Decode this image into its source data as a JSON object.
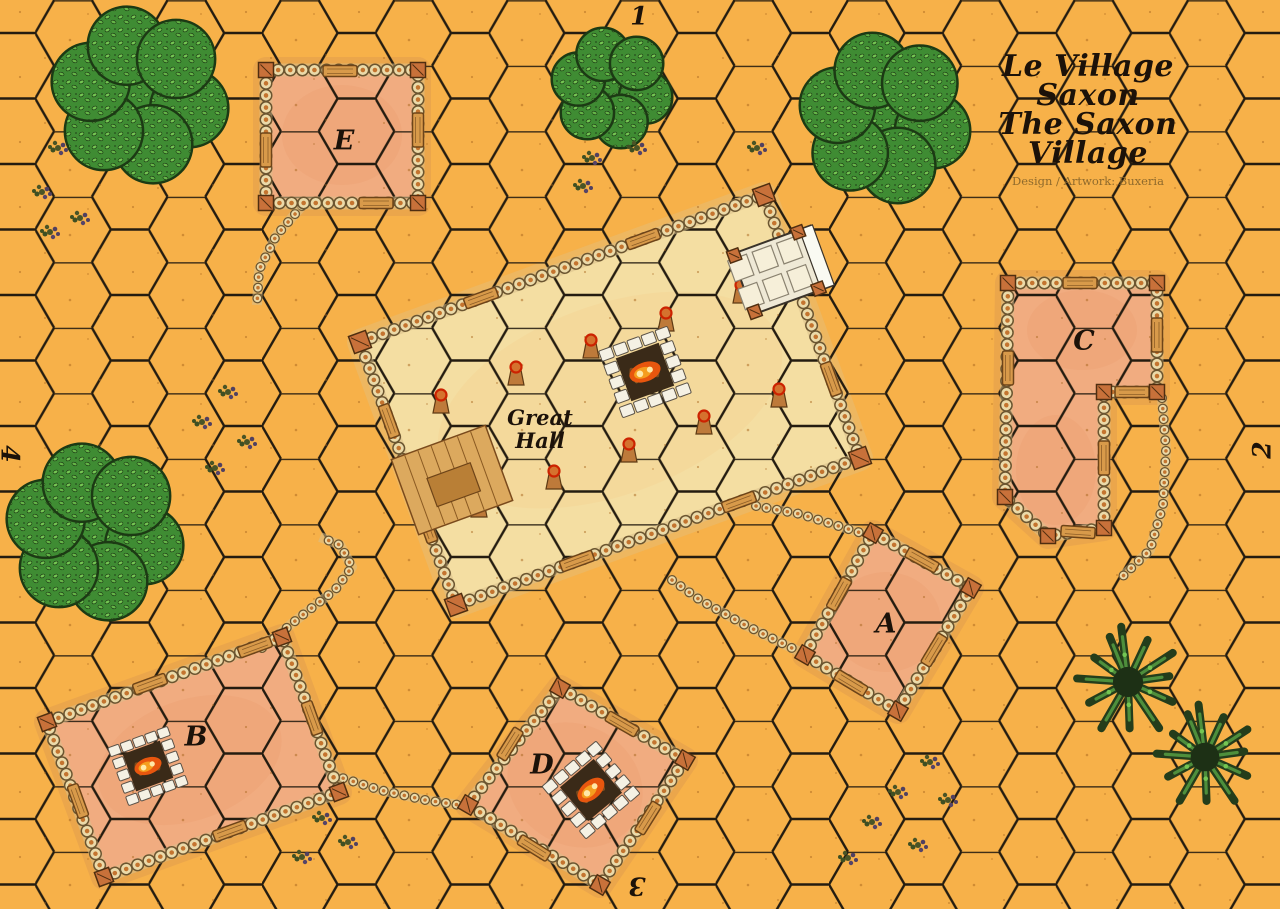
{
  "map": {
    "title_line1": "Le Village Saxon",
    "title_line2": "The Saxon Village",
    "credit": "Design / Artwork: Buxeria",
    "edge_numbers": {
      "top": "1",
      "right": "2",
      "bottom": "3",
      "left": "4"
    }
  },
  "buildings": {
    "great_hall": {
      "label_line1": "Great",
      "label_line2": "Hall"
    },
    "a": {
      "label": "A"
    },
    "b": {
      "label": "B"
    },
    "c": {
      "label": "C"
    },
    "d": {
      "label": "D"
    },
    "e": {
      "label": "E"
    }
  },
  "colors": {
    "field": "#F7B149",
    "grid_line": "#241C10",
    "floor_peach": "#F1AC80",
    "floor_tint": "#EC9A6E",
    "fringe": "rgba(218,150,80,0.4)",
    "hall_floor": "#F4DEA2",
    "hall_tint": "#F3D28E",
    "pebble_dark": "#6B5530",
    "pebble_light": "#EBDAA9",
    "pebble_core": "#C4742F",
    "mortar": "#D8C08A",
    "wood": "#D89A4A",
    "wood_dark": "#6E4418",
    "post_block": "#C8713A",
    "post_ring": "#CC2200",
    "forest_base": "#3F8C33",
    "forest_leaf": "#74C653",
    "forest_dark": "#1C3A14",
    "spiky_dark": "#243D1B",
    "spiky_leaf": "#4E8F3C",
    "hearth_stone": "#F5F1E4",
    "hearth_pit": "#3A2A18",
    "fire_orange": "#E8560E",
    "fire_mid": "#F59E1E",
    "fire_yellow": "#FFE9A8",
    "title_text": "#1C1209",
    "credit_text": "#8F6A2C",
    "speckle": "#A8651E"
  }
}
